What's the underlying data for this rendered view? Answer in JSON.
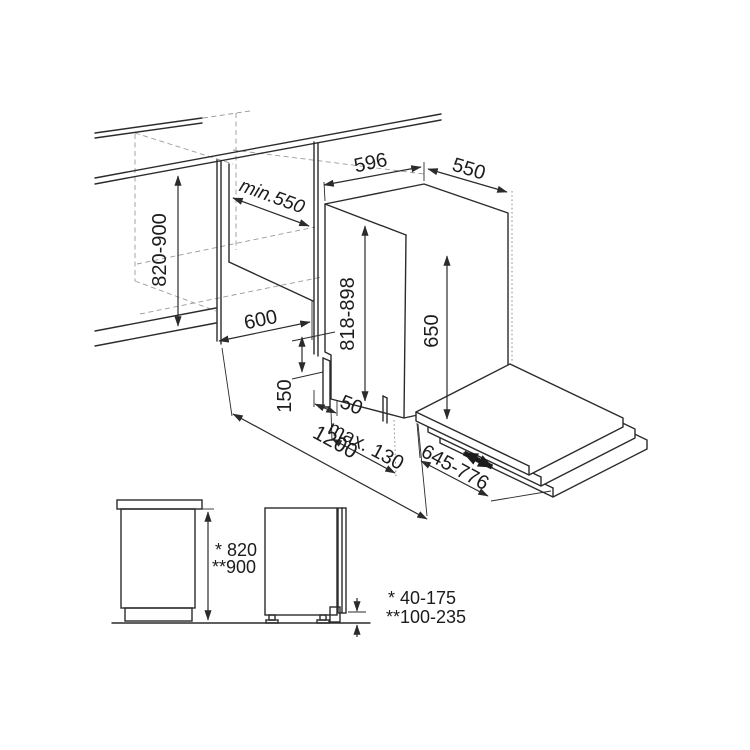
{
  "labels": {
    "dim_820_900": "820-900",
    "dim_min_550": "min.550",
    "dim_596": "596",
    "dim_550": "550",
    "dim_600": "600",
    "dim_818_898": "818-898",
    "dim_650": "650",
    "dim_150": "150",
    "dim_50": "50",
    "dim_max_130": "max. 130",
    "dim_1200": "1200",
    "dim_645_776": "645-776",
    "note_height_std": "* 820",
    "note_height_alt": "**900",
    "note_range_std": "* 40-175",
    "note_range_alt": "**100-235"
  },
  "colors": {
    "line": "#2b2b2b",
    "hidden_line": "#9a9a9a",
    "background": "#ffffff",
    "text": "#1c1c1c"
  }
}
